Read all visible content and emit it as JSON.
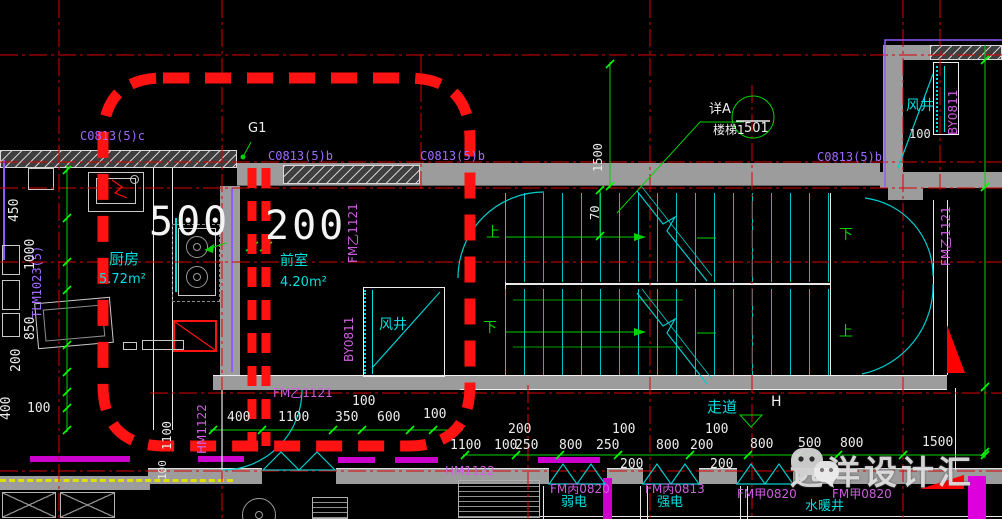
{
  "colors": {
    "background": "#000000",
    "axis_red": "#dd0000",
    "highlight_red": "#ff1212",
    "wall_gray": "#9c9c9c",
    "dim_green": "#00d400",
    "text_cyan": "#00dede",
    "code_purple": "#a06aff",
    "code_magenta": "#cf5fe0",
    "yellow": "#e0e000",
    "magenta": "#dd00dd"
  },
  "labels": {
    "g1": "G1",
    "c0813c": "C0813(5)c",
    "c0813b1": "C0813(5)b",
    "c0813b2": "C0813(5)b",
    "c0813b3": "C0813(5)b",
    "tlm1023": "TLM1023(5)",
    "fmy_anteroom": "FM乙1121",
    "fmy_bottom": "FM乙1121",
    "fmy_right": "FM乙1121",
    "by_left": "BY0811",
    "by_topright": "BY0811",
    "hm_left": "HM1122",
    "hm_bottom": "HM1122",
    "fmb0820": "FM丙0820",
    "fmb0813": "FM丙0813",
    "fmj0820a": "FM甲0820",
    "fmj0820b": "FM甲0820"
  },
  "rooms": {
    "kitchen": "厨房",
    "kitchen_area": "5.72m²",
    "anteroom": "前室",
    "anteroom_area": "4.20m²",
    "shaft_left": "风井",
    "shaft_top": "风井",
    "shaft_top_dim": "100",
    "corridor": "走道",
    "corridor_mark": "H",
    "weak_elec": "弱电",
    "strong_elec": "强电",
    "plumb_shaft": "水暖井"
  },
  "stair": {
    "up_left": "上",
    "down_left": "下",
    "down_right": "下",
    "up_right": "上",
    "run_dim": "70",
    "width_dim": "1500"
  },
  "callout": {
    "detail": "详A",
    "target": "楼梯1",
    "sheet": "501"
  },
  "highlight_dims": {
    "d500": "500",
    "d200": "200"
  },
  "dims": {
    "left_v": [
      "450",
      "1000",
      "850",
      "200"
    ],
    "v400": "400",
    "h100": "100",
    "v1100": "1100",
    "v100": "100",
    "rowA": [
      "400",
      "1100",
      "350",
      "600",
      "100"
    ],
    "rowA_top": "100",
    "rowB_top": [
      "200",
      "100",
      "100"
    ],
    "rowB": [
      "1100",
      "100",
      "250",
      "800",
      "250",
      "800",
      "200",
      "800",
      "500",
      "800",
      "1500"
    ],
    "rowB_below": [
      "200",
      "200"
    ]
  },
  "watermark": {
    "brand": "远洋设计汇"
  }
}
